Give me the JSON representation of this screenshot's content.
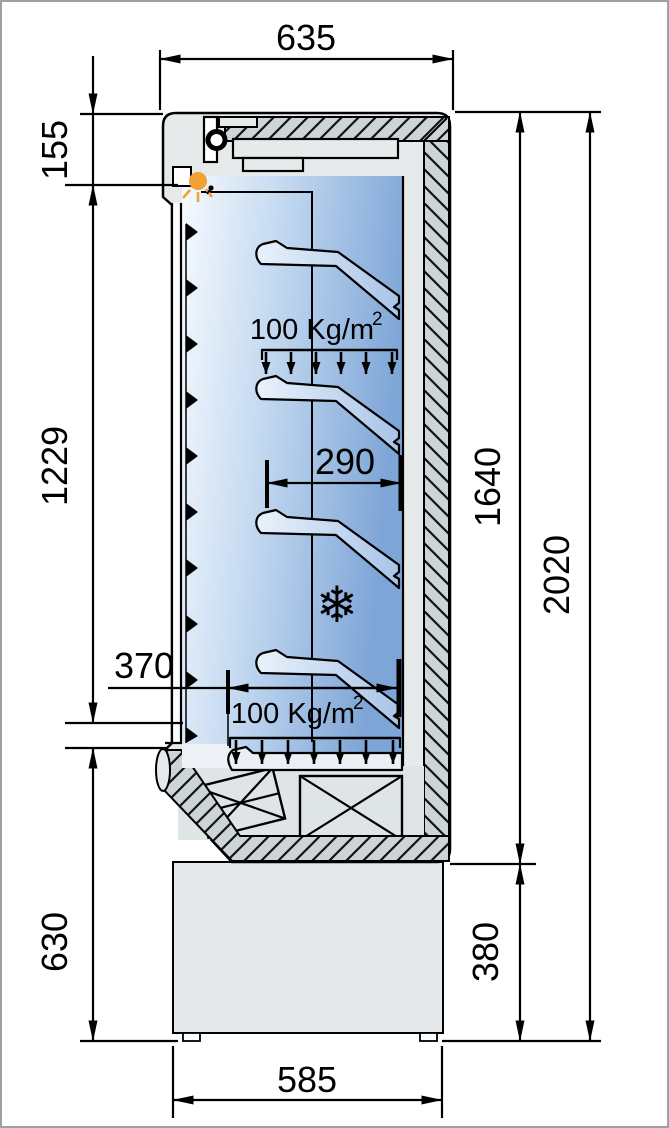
{
  "diagram": {
    "type": "technical-drawing",
    "subject": "refrigerated-cabinet-side-cross-section",
    "dimensions": {
      "top_depth": "635",
      "header_height": "155",
      "door_height": "1229",
      "lower_front_height": "630",
      "base_depth": "585",
      "shelf_depth": "290",
      "bottom_shelf_depth": "370",
      "inner_height": "1640",
      "total_height": "2020",
      "plinth_height": "380"
    },
    "labels": {
      "shelf_load": {
        "text": "100 Kg/m",
        "sup": "2"
      },
      "bottom_load": {
        "text": "100 Kg/m",
        "sup": "2"
      }
    },
    "icons": {
      "snowflake": "❄",
      "lamp": "led-light",
      "roller": "hinge-roller"
    },
    "colors": {
      "shell_gray": "#e6eaeb",
      "hatch_gray": "#ccd4d7",
      "interior_blue": "#7ea5d7",
      "lamp_orange": "#f0a233",
      "snowflake_purple": "#4a3f96",
      "line_black": "#000000",
      "page_border": "#9ba1a4"
    }
  }
}
